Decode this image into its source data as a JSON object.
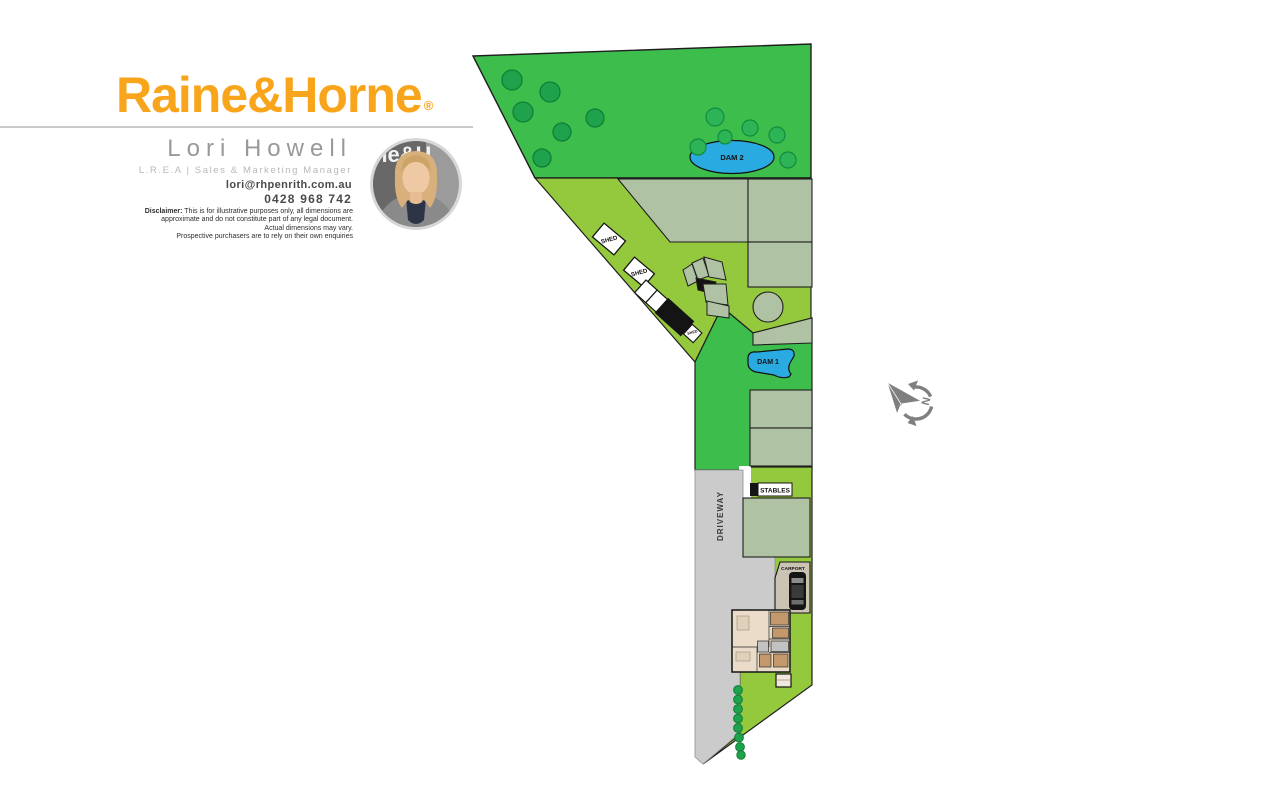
{
  "header": {
    "brand": "Raine&Horne",
    "registered_mark": "®",
    "agent_name": "Lori Howell",
    "agent_title": "L.R.E.A | Sales & Marketing Manager",
    "agent_email": "lori@rhpenrith.com.au",
    "agent_phone": "0428 968 742",
    "disclaimer": {
      "label": "Disclaimer:",
      "line1": " This is for illustrative purposes only, all dimensions are",
      "line2": "approximate and do not constitute part of any legal document.",
      "line3": "Actual dimensions may vary.",
      "line4": "Prospective purchasers are to rely on their own enquiries"
    },
    "photo_backdrop_text": "ne&H"
  },
  "plan": {
    "labels": {
      "dam2": "DAM 2",
      "dam1": "DAM 1",
      "shed": "SHED",
      "stables": "STABLES",
      "driveway": "DRIVEWAY",
      "carport": "CARPORT",
      "compass_north": "N"
    },
    "colors": {
      "grass_dark": "#3DBE4C",
      "grass_light": "#94C83D",
      "sage": "#AFC2A3",
      "water": "#29ABE2",
      "tree_dark": "#1EA24B",
      "tree_mid": "#2CB457",
      "driveway_gray": "#CBCBCB",
      "compass_gray": "#7F7F7F",
      "outline_black": "#141414",
      "house_beige": "#EADCC8",
      "house_tan": "#C3996B",
      "house_gray": "#C2C2C2",
      "carport_tan": "#CBC3B4",
      "brand_orange": "#F9A51B"
    }
  }
}
